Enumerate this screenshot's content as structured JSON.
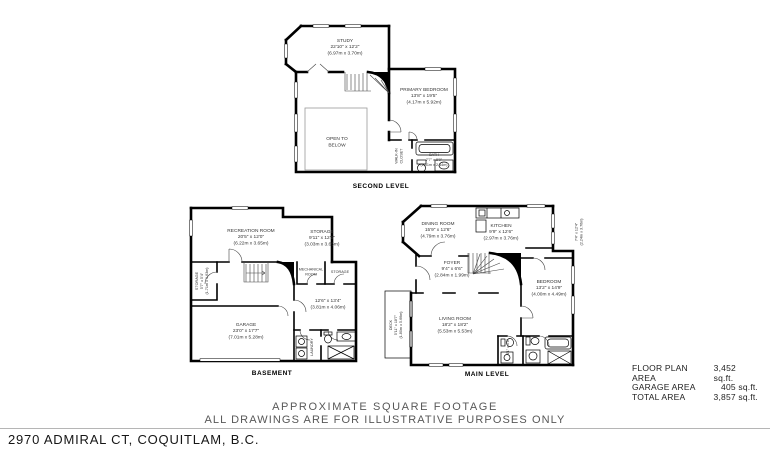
{
  "plans": {
    "second": {
      "caption": "SECOND LEVEL",
      "rooms": {
        "study": {
          "lines": [
            "STUDY",
            "22'10\" x 12'2\"",
            "(6.97m x 3.70m)"
          ]
        },
        "primary_bedroom": {
          "lines": [
            "PRIMARY BEDROOM",
            "13'8\" x 19'5\"",
            "(4.17m x 5.92m)"
          ]
        },
        "open_to_below": {
          "lines": [
            "OPEN TO",
            "BELOW"
          ]
        },
        "walk_in_closet": {
          "lines": [
            "WALK-IN",
            "CLOSET"
          ]
        },
        "bath": {
          "lines": [
            "BATH",
            "7'7\" x 8'0\"",
            "(2.31m x 2.44m)"
          ]
        }
      }
    },
    "basement": {
      "caption": "BASEMENT",
      "rooms": {
        "recreation_room": {
          "lines": [
            "RECREATION ROOM",
            "20'5\" x 12'0\"",
            "(6.22m x 3.65m)"
          ]
        },
        "storage_top": {
          "lines": [
            "STORAGE",
            "9'11\" x 12'0\"",
            "(3.03m x 3.65m)"
          ]
        },
        "storage_left": {
          "lines": [
            "STORAGE",
            "5'7\" x 5'4\"",
            "(1.71m x 1.63m)"
          ]
        },
        "mechanical_room": {
          "lines": [
            "MECHANICAL",
            "ROOM"
          ]
        },
        "storage_right": {
          "lines": [
            "STORAGE"
          ]
        },
        "flex_room": {
          "lines": [
            "12'6\" x 13'4\"",
            "(3.81m x 4.06m)"
          ]
        },
        "garage": {
          "lines": [
            "GARAGE",
            "23'0\" x 17'7\"",
            "(7.01m x 5.28m)"
          ]
        },
        "laundry": {
          "lines": [
            "LAUNDRY"
          ]
        }
      }
    },
    "main": {
      "caption": "MAIN LEVEL",
      "rooms": {
        "dining_room": {
          "lines": [
            "DINING ROOM",
            "15'9\" x 12'6\"",
            "(4.79m x 3.76m)"
          ]
        },
        "kitchen": {
          "lines": [
            "KITCHEN",
            "9'9\" x 12'6\"",
            "(2.97m x 3.76m)"
          ]
        },
        "deck_right": {
          "lines": [
            "7'4\" x 12'4\"",
            "(2.24m x 3.76m)"
          ]
        },
        "foyer": {
          "lines": [
            "FOYER",
            "9'4\" x 6'6\"",
            "(2.84m x 1.99m)"
          ]
        },
        "bedroom": {
          "lines": [
            "BEDROOM",
            "13'2\" x 14'9\"",
            "(4.00m x 4.49m)"
          ]
        },
        "living_room": {
          "lines": [
            "LIVING ROOM",
            "18'2\" x 18'2\"",
            "(5.53m x 5.53m)"
          ]
        },
        "deck_left": {
          "lines": [
            "DECK",
            "5'11\" x 18'7\"",
            "(1.80m x 5.66m)"
          ]
        },
        "wc": {
          "lines": [
            "4'1\" x 5'8\""
          ]
        }
      }
    }
  },
  "footer": {
    "areas": [
      {
        "label": "FLOOR PLAN AREA",
        "value": "3,452 sq.ft."
      },
      {
        "label": "GARAGE AREA",
        "value": "405 sq.ft."
      },
      {
        "label": "TOTAL AREA",
        "value": "3,857 sq.ft."
      }
    ],
    "note_line1": "APPROXIMATE SQUARE FOOTAGE",
    "note_line2": "ALL DRAWINGS ARE FOR ILLUSTRATIVE PURPOSES ONLY",
    "address": "2970 ADMIRAL CT, COQUITLAM, B.C."
  }
}
